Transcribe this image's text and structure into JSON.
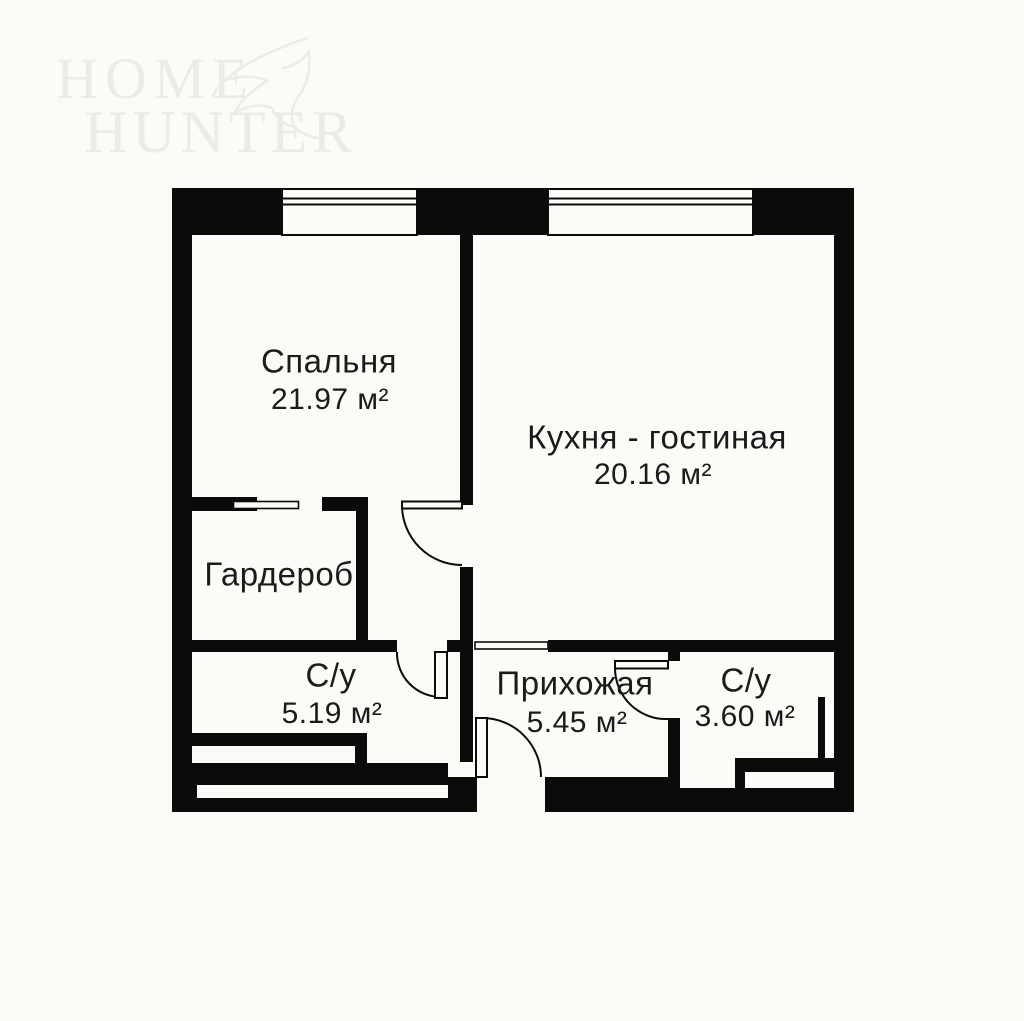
{
  "watermark": {
    "line1": "HOME",
    "line2": "HUNTER"
  },
  "rooms": {
    "bedroom": {
      "name": "Спальня",
      "area": "21.97 м²"
    },
    "kitchen_living": {
      "name": "Кухня - гостиная",
      "area": "20.16 м²"
    },
    "wardrobe": {
      "name": "Гардероб"
    },
    "bathroom_left": {
      "name": "С/у",
      "area": "5.19 м²"
    },
    "hallway": {
      "name": "Прихожая",
      "area": "5.45 м²"
    },
    "bathroom_right": {
      "name": "С/у",
      "area": "3.60 м²"
    }
  },
  "colors": {
    "wall": "#0b0b0b",
    "background": "#fbfbf8",
    "text": "#1b1b1b",
    "watermark": "#ebebe7"
  }
}
